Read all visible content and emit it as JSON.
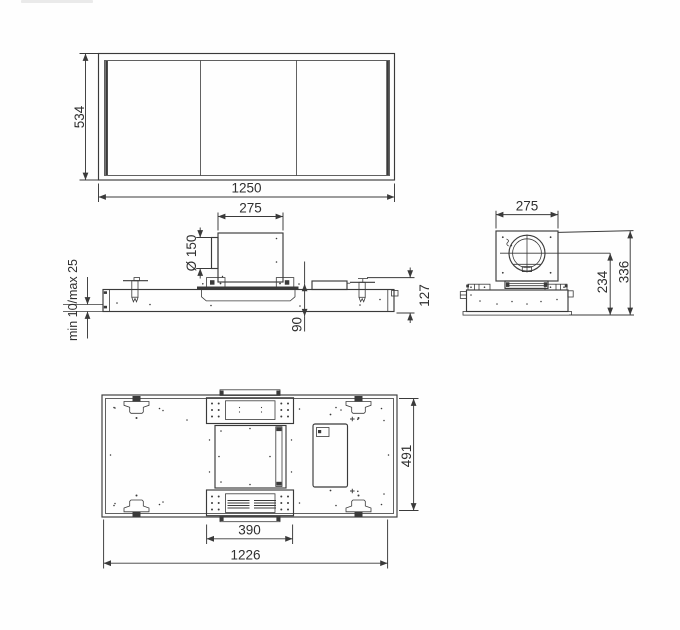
{
  "page": {
    "bg": "#fefefe"
  },
  "drawing": {
    "line_color": "#3a3a3a",
    "text_color": "#2f2f2f",
    "front_view": {
      "height_label": "534",
      "width_label": "1250"
    },
    "side_view": {
      "duct_box_width_label": "275",
      "duct_diameter_label": "Ø 150",
      "ceiling_thickness_label": "min 10/max 25",
      "recess_depth_label": "90",
      "body_height_label": "127"
    },
    "end_view": {
      "duct_box_width_label": "275",
      "duct_axis_height_label": "234",
      "overall_height_label": "336"
    },
    "bottom_view": {
      "bracket_span_label": "390",
      "body_length_label": "1226",
      "body_depth_label": "491"
    }
  }
}
